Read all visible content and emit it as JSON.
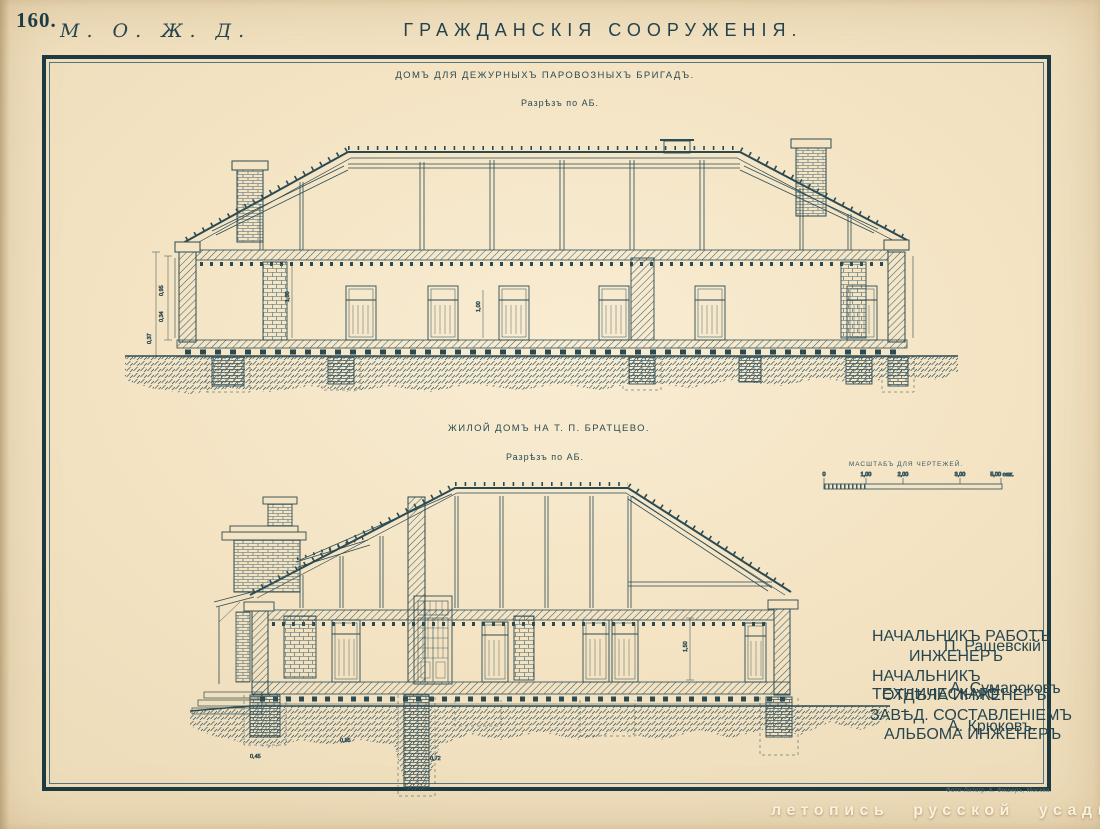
{
  "page": {
    "number": "160.",
    "railway_mark": "М. О. Ж. Д.",
    "title": "ГРАЖДАНСКІЯ СООРУЖЕНІЯ.",
    "imprint": "Фото-Литогр. К. Фишеръ, Москва.",
    "watermark": "летопись русской усадьбы"
  },
  "drawing1": {
    "title": "ДОМЪ ДЛЯ ДЕЖУРНЫХЪ ПАРОВОЗНЫХЪ БРИГАДЪ.",
    "section_label": "Разрѣзъ по АБ.",
    "dims": [
      "0,95",
      "0,34",
      "0,37",
      "1,30",
      "1,00"
    ]
  },
  "drawing2": {
    "title": "ЖИЛОЙ ДОМЪ НА Т. П. БРАТЦЕВО.",
    "section_label": "Разрѣзъ по АБ.",
    "dims": [
      "0,45",
      "0,85",
      "0,72",
      "1,50"
    ]
  },
  "scale_bar": {
    "label": "МАСШТАБЪ ДЛЯ ЧЕРТЕЖЕЙ.",
    "ticks": [
      "0",
      "1,00",
      "2,00",
      "3,00",
      "5,00 саж."
    ]
  },
  "signatures": [
    {
      "role1": "НАЧАЛЬНИКЪ РАБОТЪ",
      "role2": "ИНЖЕНЕРЪ",
      "name": "П. Рашевскій"
    },
    {
      "role1": "НАЧАЛЬНИКЪ ТЕХНИЧЕСКАГО",
      "role2": "ОТДѢЛА ИНЖЕНЕРЪ",
      "name": "А. Сумароковъ"
    },
    {
      "role1": "ЗАВѢД. СОСТАВЛЕНІЕМЪ",
      "role2": "АЛЬБОМА ИНЖЕНЕРЪ",
      "name": "А. Крюковъ."
    }
  ],
  "colors": {
    "paper": "#f4e4c4",
    "ink": "#2b4a52",
    "frame": "#1d3a42",
    "watermark": "#faf1de"
  }
}
